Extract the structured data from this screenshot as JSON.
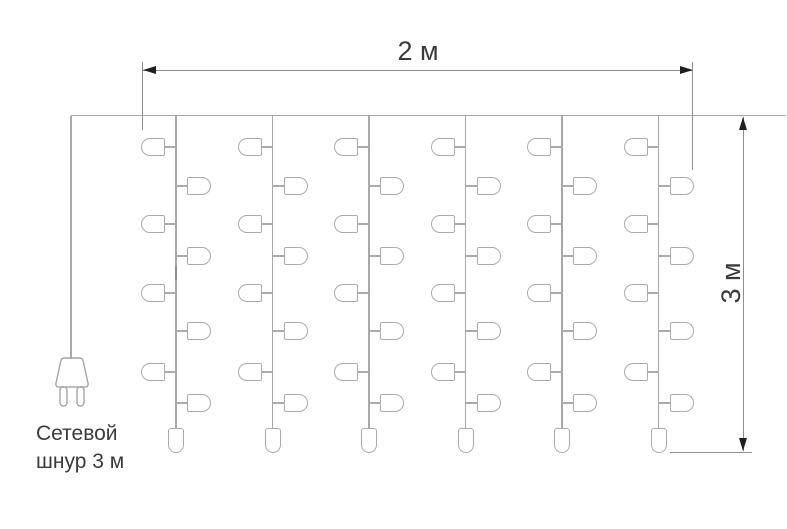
{
  "diagram": {
    "type": "curtain-lights-dimension-drawing",
    "width_label": "2 м",
    "height_label": "3 м",
    "cord_label": {
      "line1": "Сетевой",
      "line2": "шнур 3 м"
    },
    "counts": {
      "strands": 6,
      "side_bulbs_per_strand": 8,
      "end_bulbs_per_strand": 1
    },
    "colors": {
      "wire": "#a8a8a8",
      "bulb_outline": "#ababab",
      "dimension_line": "#8f8f8f",
      "arrow": "#1f1f1f",
      "text": "#3b3b3b",
      "background": "#ffffff"
    },
    "geometry": {
      "canvas": {
        "w": 787,
        "h": 529
      },
      "wire": {
        "y": 115.5,
        "x1": 71,
        "x2": 786
      },
      "cord": {
        "x": 71,
        "y1": 116,
        "y2": 359
      },
      "strands": {
        "xs": [
          176,
          272.5,
          369,
          465.5,
          562,
          658.5
        ],
        "top": 116,
        "bottom": 429,
        "left_bulb_ys": [
          147,
          224,
          293,
          372
        ],
        "right_bulb_ys": [
          186,
          256,
          331,
          403
        ],
        "bulb": {
          "w": 24,
          "h": 18,
          "stem": 11
        },
        "end_bulb": {
          "w": 16,
          "h": 25,
          "top": 428
        }
      },
      "splice": {
        "x": 176,
        "y1": 266,
        "y2": 280
      },
      "width_dim": {
        "line_y": 70,
        "x1": 143,
        "x2": 693,
        "ext_left": {
          "x": 142.5,
          "y1": 62,
          "y2": 130
        },
        "ext_right": {
          "x": 692.5,
          "y1": 62,
          "y2": 170
        }
      },
      "height_dim": {
        "line_x": 743.5,
        "y1": 117,
        "y2": 451,
        "ext_bottom": {
          "y": 452,
          "x1": 670,
          "x2": 752
        }
      },
      "arrow": {
        "len": 13,
        "half": 4.5
      }
    }
  }
}
